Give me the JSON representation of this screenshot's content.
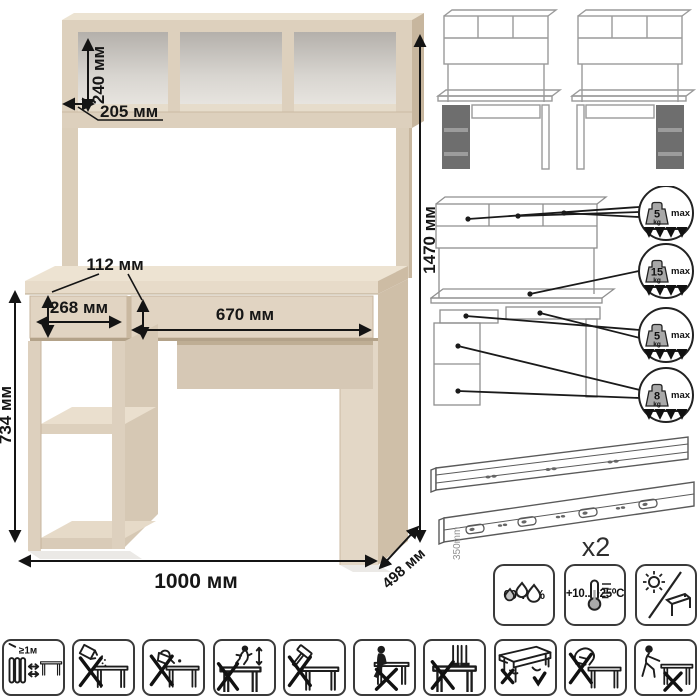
{
  "main_diagram": {
    "dimensions": {
      "shelf_height": "240 мм",
      "shelf_depth": "205 мм",
      "total_height": "1470 мм",
      "drawer_front_height": "112 мм",
      "left_drawer_width": "268 мм",
      "right_drawer_width": "670 мм",
      "desk_height": "734 мм",
      "total_width": "1000 мм",
      "depth": "498 мм"
    }
  },
  "load_limits": [
    {
      "target": "hutch-shelves",
      "value": "5",
      "unit": "kg",
      "qualifier": "max"
    },
    {
      "target": "desktop",
      "value": "15",
      "unit": "kg",
      "qualifier": "max"
    },
    {
      "target": "drawers",
      "value": "5",
      "unit": "kg",
      "qualifier": "max"
    },
    {
      "target": "pedestal-shelves",
      "value": "8",
      "unit": "kg",
      "qualifier": "max"
    }
  ],
  "slides": {
    "length_label": "350mm",
    "quantity_label": "x2"
  },
  "climate": {
    "humidity_label": "60-70%",
    "temperature_label": "+10...+25⁰C"
  },
  "warnings": {
    "min_distance_label": "≥1м"
  },
  "icons": {
    "variants": [
      "desk-pedestal-left-thumbnail",
      "desk-pedestal-right-thumbnail"
    ],
    "climate": [
      "humidity-drops-icon",
      "thermometer-icon",
      "no-direct-sunlight-icon"
    ],
    "warnings": [
      "keep-1m-from-heat",
      "no-abrasive-powder",
      "no-hot-liquids",
      "no-jumping-on-top",
      "no-hammering",
      "no-sitting-on-top",
      "no-standing-on-top",
      "lift-correctly",
      "no-lifting-by-top",
      "no-dragging"
    ]
  },
  "colors": {
    "wood_front": "#ddd0bd",
    "wood_top": "#ece3d2",
    "wood_side": "#cdbca5",
    "cubby_gray": "#c4c0bb",
    "line_art_gray": "#9a9a9a",
    "annotation_black": "#141414",
    "tile_border": "#3a3a3a"
  }
}
